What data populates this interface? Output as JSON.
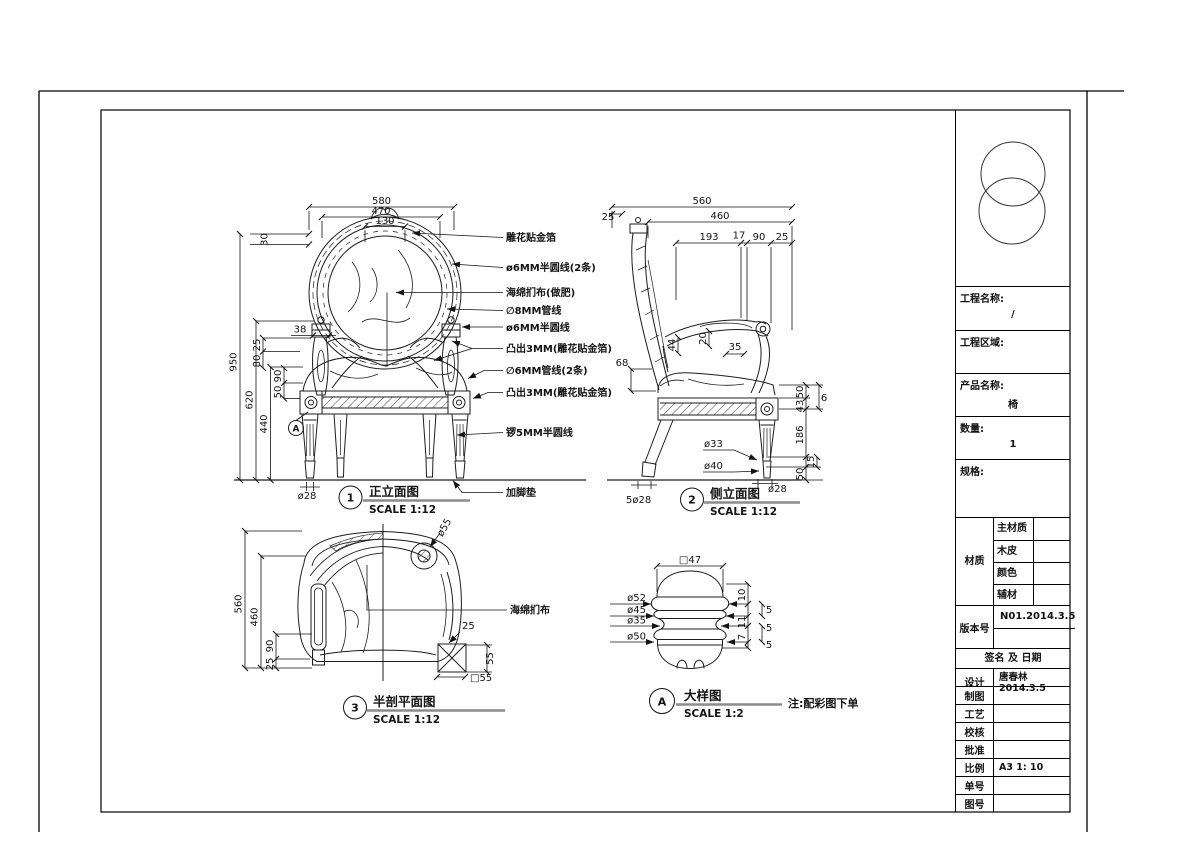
{
  "views": {
    "front": {
      "marker": "1",
      "title": "正立面图",
      "scale": "SCALE 1:12",
      "detail_marker": "A",
      "dims": {
        "w580": "580",
        "w470": "470",
        "w130": "130",
        "h30": "30",
        "h950": "950",
        "h620": "620",
        "h440": "440",
        "w38": "38",
        "d25": "25",
        "d80": "80",
        "d90": "90",
        "d50": "50",
        "foot": "ø28"
      },
      "leaders": [
        "雕花贴金箔",
        "ø6MM半圆线(2条)",
        "海绵扪布(做肥)",
        "∅8MM管线",
        "ø6MM半圆线",
        "凸出3MM(雕花贴金箔)",
        "∅6MM管线(2条)",
        "凸出3MM(雕花贴金箔)",
        "锣5MM半圆线",
        "加脚垫"
      ]
    },
    "side": {
      "marker": "2",
      "title": "侧立面图",
      "scale": "SCALE 1:12",
      "dims": {
        "d560": "560",
        "d460": "460",
        "d25a": "25",
        "d193": "193",
        "d17": "17",
        "d90": "90",
        "d25b": "25",
        "d44": "44",
        "d20": "20",
        "d35": "35",
        "d68": "68",
        "r50a": "50",
        "r43": "43",
        "r6": "6",
        "r186": "186",
        "r15": "15",
        "r50b": "50",
        "leg1": "ø33",
        "leg2": "ø40",
        "foot": "ø28",
        "feet": "5ø28"
      }
    },
    "plan": {
      "marker": "3",
      "title": "半剖平面图",
      "scale": "SCALE 1:12",
      "label": "海绵扪布",
      "dims": {
        "d560": "560",
        "d460": "460",
        "d90": "90",
        "d25": "25",
        "scroll": "ø55",
        "edge25": "25",
        "side55": "55",
        "block": "□55"
      }
    },
    "detail": {
      "marker": "A",
      "title": "大样图",
      "scale": "SCALE 1:2",
      "note": "注:配彩图下单",
      "dims": {
        "top": "□47",
        "l1": "ø52",
        "l2": "ø45",
        "l3": "ø35",
        "l4": "ø50",
        "r1": "10",
        "r2": "5",
        "r3": "11",
        "r4": "5",
        "r5": "7",
        "r6": "5"
      }
    }
  },
  "title_block": {
    "project_name_label": "工程名称:",
    "project_name_value": "/",
    "project_area_label": "工程区域:",
    "product_name_label": "产品名称:",
    "product_name_value": "椅",
    "quantity_label": "数量:",
    "quantity_value": "1",
    "spec_label": "规格:",
    "material_label": "材质",
    "material_rows": [
      {
        "label": "主材质",
        "value": ""
      },
      {
        "label": "木皮",
        "value": ""
      },
      {
        "label": "颜色",
        "value": ""
      },
      {
        "label": "辅材",
        "value": ""
      }
    ],
    "version_label": "版本号",
    "version_value": "N01.2014.3.5",
    "sign_header": "签名 及 日期",
    "sign_rows": [
      {
        "label": "设计",
        "value": "唐春林 2014.3.5"
      },
      {
        "label": "制图",
        "value": ""
      },
      {
        "label": "工艺",
        "value": ""
      },
      {
        "label": "校核",
        "value": ""
      },
      {
        "label": "批准",
        "value": ""
      },
      {
        "label": "比例",
        "value": "A3 1: 10"
      },
      {
        "label": "单号",
        "value": ""
      },
      {
        "label": "图号",
        "value": ""
      }
    ]
  }
}
